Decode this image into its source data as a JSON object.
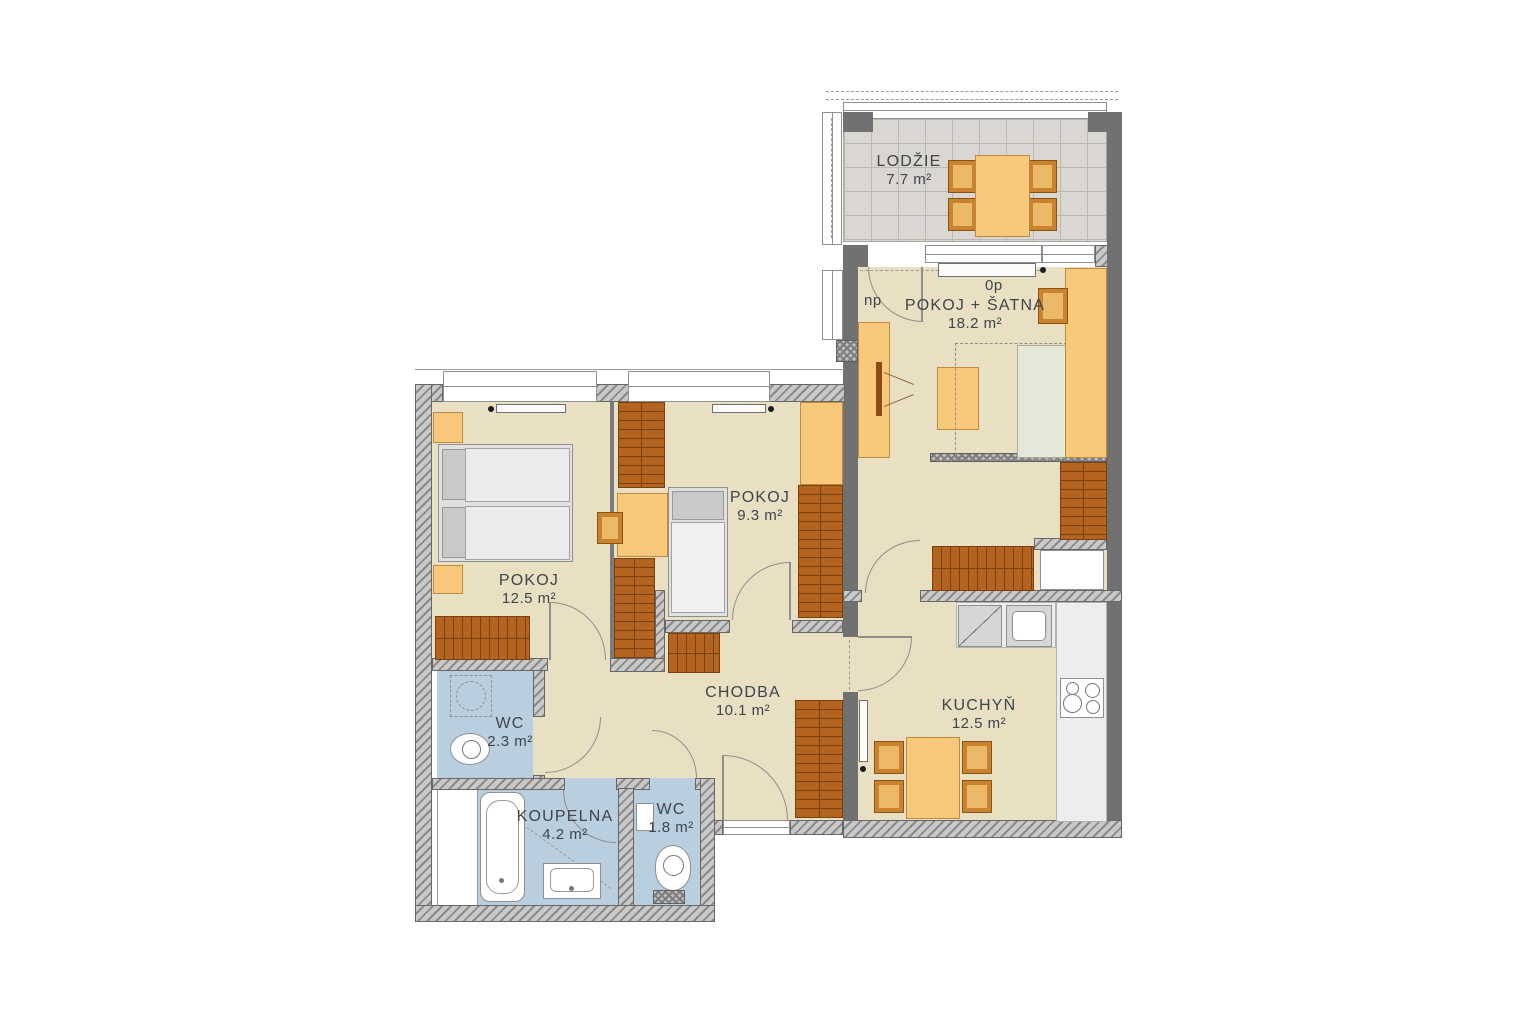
{
  "plan": {
    "title": "Apartment floor plan",
    "annotations": {
      "np": "np",
      "op": "0p"
    },
    "rooms": [
      {
        "id": "lodzie",
        "name": "LODŽIE",
        "area": "7.7 m²"
      },
      {
        "id": "pokoj-satna",
        "name": "POKOJ + ŠATNA",
        "area": "18.2 m²"
      },
      {
        "id": "pokoj-9",
        "name": "POKOJ",
        "area": "9.3 m²"
      },
      {
        "id": "pokoj-12",
        "name": "POKOJ",
        "area": "12.5 m²"
      },
      {
        "id": "chodba",
        "name": "CHODBA",
        "area": "10.1 m²"
      },
      {
        "id": "kuchyn",
        "name": "KUCHYŇ",
        "area": "12.5 m²"
      },
      {
        "id": "wc-2",
        "name": "WC",
        "area": "2.3 m²"
      },
      {
        "id": "koupelna",
        "name": "KOUPELNA",
        "area": "4.2 m²"
      },
      {
        "id": "wc-1",
        "name": "WC",
        "area": "1.8 m²"
      }
    ],
    "colors": {
      "floor": "#e9dfc3",
      "wet_floor": "#b9cedf",
      "loggia_floor": "#dad6d1",
      "wall": "#717171",
      "furniture_light": "#f8c87b",
      "furniture_dark": "#b4641f",
      "chair": "#c9822d",
      "text": "#3e454b"
    }
  }
}
